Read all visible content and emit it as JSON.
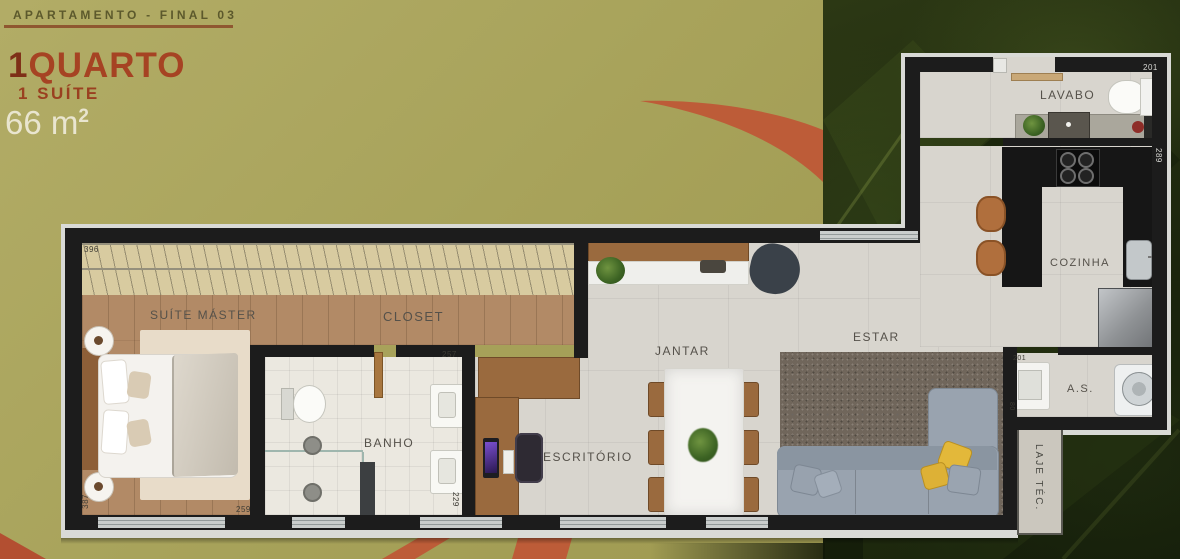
{
  "header": {
    "subtitle": "APARTAMENTO - FINAL 03",
    "unit_number": "1",
    "unit_word": "QUARTO",
    "suite_line": "1 SUÍTE",
    "area_value": "66 m",
    "area_exponent": "2"
  },
  "plan": {
    "rooms": {
      "suite": {
        "label": "SUÍTE MÁSTER"
      },
      "closet": {
        "label": "CLOSET"
      },
      "banho": {
        "label": "BANHO"
      },
      "escritorio": {
        "label": "ESCRITÓRIO"
      },
      "jantar": {
        "label": "JANTAR"
      },
      "estar": {
        "label": "ESTAR"
      },
      "lavabo": {
        "label": "LAVABO"
      },
      "cozinha": {
        "label": "COZINHA"
      },
      "area_servico": {
        "label": "A.S."
      },
      "laje": {
        "label": "LAJE TÉC."
      }
    },
    "dims": {
      "pergola": "396",
      "suite_width": "259",
      "suite_height": "387",
      "banho_width": "257",
      "banho_height": "229",
      "lavabo_width": "201",
      "cozinha_height": "289",
      "as_width": "201",
      "as_height": "80"
    }
  },
  "colors": {
    "background_olive": "#a8a35b",
    "accent_brick": "#bd5c38",
    "title_dark_red": "#7e2f17",
    "title_red": "#a64323",
    "area_cream": "#e9e5cf",
    "wall": "#1c1c1c",
    "leaf_dark_green": "#1c260c"
  }
}
